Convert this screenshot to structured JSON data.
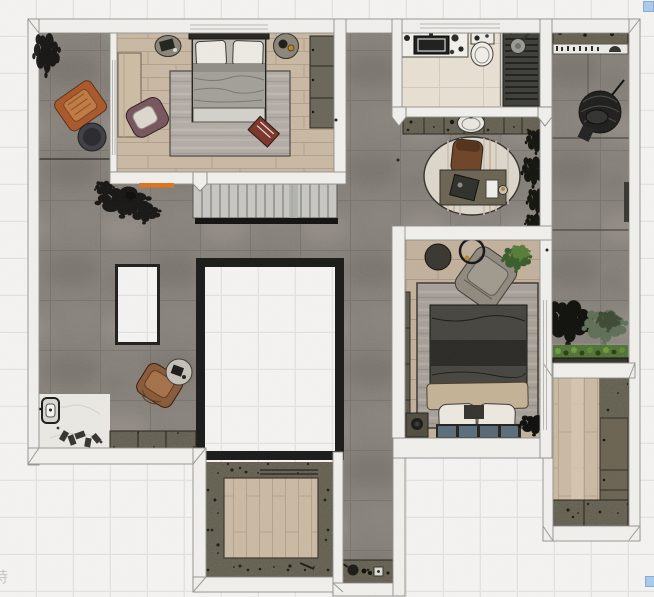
{
  "canvas": {
    "width": 654,
    "height": 597
  },
  "watermark": {
    "text": "特",
    "x": -7,
    "y": 566,
    "color": "#c9c8c5"
  },
  "selection_handles": {
    "color": "#abc9ea",
    "border_color": "#86add8",
    "size": 11,
    "positions": [
      {
        "x": 643,
        "y": 1
      },
      {
        "x": 645,
        "y": 576
      }
    ]
  },
  "colors": {
    "background": "#f4f3f1",
    "grid_line": "#e3e2e0",
    "wall_fill": "#f0efec",
    "wall_stroke": "#8f8e8a",
    "concrete_floor": "#837d76",
    "wood_floor_light": "#c9b8a2",
    "wood_floor_mid": "#c2b09a",
    "bathroom_tile": "#e9e1d3",
    "cabinet_olive": "#5b5645",
    "shower_slats": "#3f3f39",
    "void_frame": "#1a1a18",
    "rug_gray": "#b2aba4",
    "accent_orange_threshold": "#e0731c",
    "armchair_leather": "#a9582a",
    "hedge_green": "#3c651d",
    "bed_duvet_dark": "#46453f",
    "pillow_blue_gray": "#5b6d7c"
  },
  "scene": {
    "type": "apartment floor plan, top-down 3D render",
    "rooms": [
      {
        "id": "master-bedroom",
        "floor": "wood planks"
      },
      {
        "id": "terrace-left",
        "floor": "concrete tile"
      },
      {
        "id": "living-hall",
        "floor": "concrete tile"
      },
      {
        "id": "stair-hall",
        "floor": "stairs"
      },
      {
        "id": "bathroom",
        "floor": "cream marble + shower slats"
      },
      {
        "id": "study-nook",
        "floor": "concrete tile + oval rug"
      },
      {
        "id": "bedroom-2",
        "floor": "wood planks"
      },
      {
        "id": "balcony-right",
        "floor": "concrete tile + planters"
      },
      {
        "id": "walk-in-closet",
        "floor": "wood planks + shelving"
      },
      {
        "id": "courtyard-room",
        "floor": "wood deck + planter border"
      },
      {
        "id": "entry",
        "floor": "white marble"
      },
      {
        "id": "floor-void-large",
        "floor": "opening"
      },
      {
        "id": "floor-void-small",
        "floor": "opening"
      }
    ],
    "objects": [
      "double-bed",
      "pillows",
      "nightstand",
      "wardrobe",
      "area-rug",
      "accent-armchair",
      "leather-lounge-chair",
      "round-side-table",
      "desk",
      "desk-chair",
      "laptop",
      "vanity-sink",
      "toilet",
      "shower-head",
      "hanging-egg-chair",
      "planter-hedge",
      "black-plant-silhouette",
      "tv-cabinet",
      "stairs",
      "wash-basin-counter",
      "tea-counter",
      "door-lock-device",
      "slippers",
      "red-mat",
      "orange-door-threshold"
    ]
  }
}
